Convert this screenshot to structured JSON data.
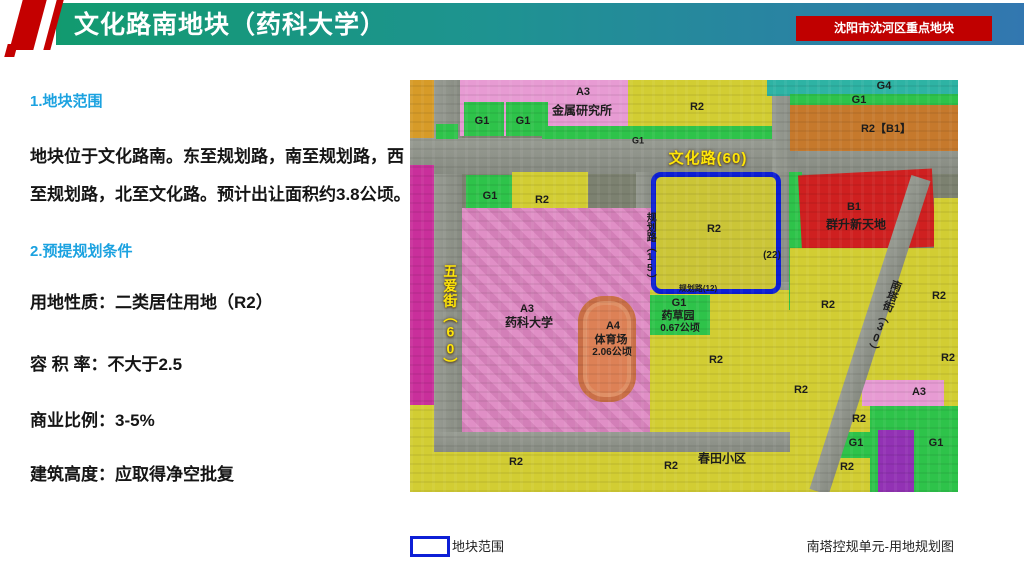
{
  "header": {
    "title": "文化路南地块（药科大学）",
    "badge": "沈阳市沈河区重点地块",
    "colors": {
      "gradient_left": "#129a6f",
      "gradient_right": "#3277b0",
      "accent_red": "#c00000"
    }
  },
  "sections": {
    "s1_title": "1.地块范围",
    "s1_body": "地块位于文化路南。东至规划路，南至规划路，西至规划路，北至文化路。预计出让面积约3.8公顷。",
    "s2_title": "2.预提规划条件",
    "s2_items": [
      "用地性质：二类居住用地（R2）",
      "容 积 率：不大于2.5",
      "商业比例：3-5%",
      "建筑高度：应取得净空批复"
    ]
  },
  "map": {
    "zone_colors": {
      "R2_residential_yellow": "#d2cd33",
      "A3_campus_pink": "#e08fc6",
      "G1_green": "#2ec34a",
      "G4_teal": "#2eb3a4",
      "B1_red": "#cf2020",
      "R2B1_orange": "#c6792c",
      "A4_stadium_orange": "#dd8156",
      "magenta": "#c92f9b",
      "purple": "#9232b4",
      "boundary_blue": "#0d1fd6",
      "road_label_yellow": "#ffe608"
    },
    "labels": [
      {
        "text": "A3",
        "x": 173,
        "y": 13
      },
      {
        "text": "金属研究所",
        "x": 172,
        "y": 31,
        "s": 12
      },
      {
        "text": "G1",
        "x": 72,
        "y": 42
      },
      {
        "text": "G1",
        "x": 113,
        "y": 42
      },
      {
        "text": "R2",
        "x": 287,
        "y": 28
      },
      {
        "text": "G4",
        "x": 474,
        "y": 7
      },
      {
        "text": "G1",
        "x": 449,
        "y": 21
      },
      {
        "text": "R2【B1】",
        "x": 476,
        "y": 50
      },
      {
        "text": "G1",
        "x": 228,
        "y": 61,
        "s": 9
      },
      {
        "text": "文化路(60)",
        "x": 298,
        "y": 79,
        "t": "road-lbl",
        "s": 15
      },
      {
        "text": "G1",
        "x": 80,
        "y": 117
      },
      {
        "text": "R2",
        "x": 132,
        "y": 121
      },
      {
        "text": "规划路（15）",
        "x": 239,
        "y": 168,
        "v": 1,
        "s": 10
      },
      {
        "text": "R2",
        "x": 304,
        "y": 150
      },
      {
        "text": "(22)",
        "x": 362,
        "y": 176,
        "s": 10
      },
      {
        "text": "B1",
        "x": 444,
        "y": 128
      },
      {
        "text": "群升新天地",
        "x": 446,
        "y": 145,
        "s": 12
      },
      {
        "text": "规划路(12)",
        "x": 288,
        "y": 209,
        "s": 8
      },
      {
        "text": "G1",
        "x": 269,
        "y": 224
      },
      {
        "text": "药草园",
        "x": 268,
        "y": 237,
        "s": 11
      },
      {
        "text": "0.67公顷",
        "x": 270,
        "y": 249,
        "s": 10
      },
      {
        "text": "A3",
        "x": 117,
        "y": 230
      },
      {
        "text": "药科大学",
        "x": 119,
        "y": 243,
        "s": 12
      },
      {
        "text": "A4",
        "x": 203,
        "y": 247
      },
      {
        "text": "体育场",
        "x": 201,
        "y": 261,
        "s": 11
      },
      {
        "text": "2.06公顷",
        "x": 202,
        "y": 273,
        "s": 10
      },
      {
        "text": "五爱街（60）",
        "x": 40,
        "y": 238,
        "t": "road-lbl",
        "v": 1,
        "s": 14
      },
      {
        "text": "R2",
        "x": 306,
        "y": 281
      },
      {
        "text": "R2",
        "x": 391,
        "y": 311
      },
      {
        "text": "R2",
        "x": 418,
        "y": 226
      },
      {
        "text": "南塔街（30）",
        "x": 473,
        "y": 237,
        "v": 1,
        "r": 20,
        "s": 11
      },
      {
        "text": "R2",
        "x": 529,
        "y": 217
      },
      {
        "text": "R2",
        "x": 538,
        "y": 279
      },
      {
        "text": "R2",
        "x": 106,
        "y": 383
      },
      {
        "text": "R2",
        "x": 261,
        "y": 387
      },
      {
        "text": "R2",
        "x": 449,
        "y": 340
      },
      {
        "text": "G1",
        "x": 446,
        "y": 364
      },
      {
        "text": "R2",
        "x": 437,
        "y": 388
      },
      {
        "text": "G1",
        "x": 526,
        "y": 364
      },
      {
        "text": "春田小区",
        "x": 312,
        "y": 379,
        "s": 12
      },
      {
        "text": "A3",
        "x": 509,
        "y": 313
      }
    ],
    "legend": {
      "boundary": "地块范围",
      "caption": "南塔控规单元-用地规划图"
    }
  }
}
